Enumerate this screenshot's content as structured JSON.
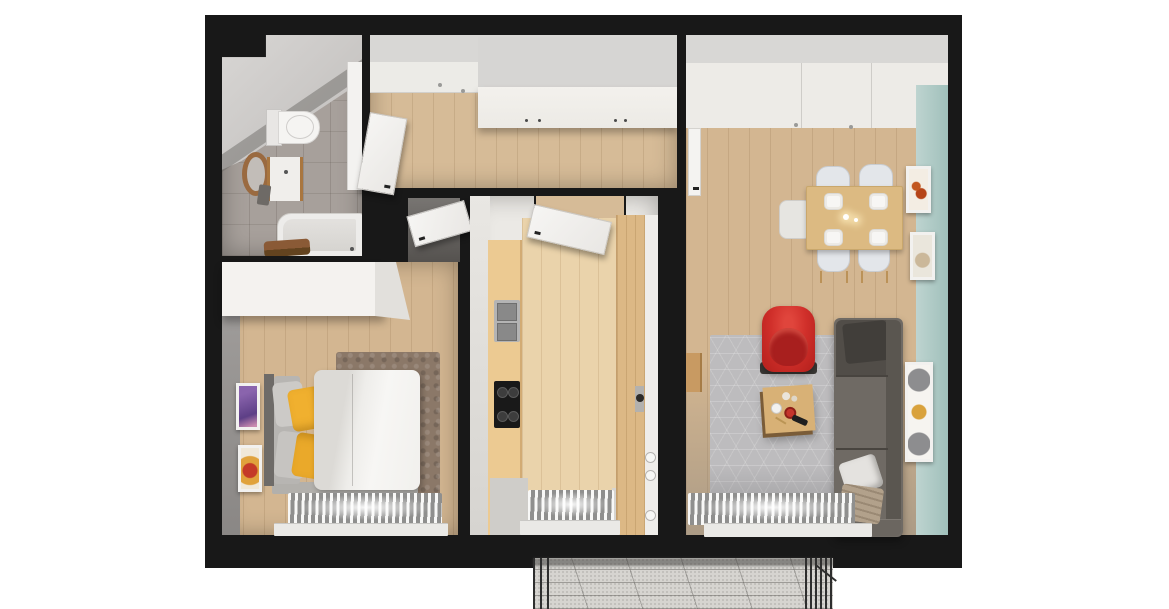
{
  "meta": {
    "title": "Two-room apartment — top-down 3D floor plan render",
    "view": "top-down axonometric",
    "visible_text": "none"
  },
  "colors": {
    "page_bg": "#ffffff",
    "wall": "#181818",
    "wood_floor": "#d3b691",
    "wood_floor_light": "#ead3ab",
    "hall_wood": "#d6bb97",
    "tile": "#a7a09b",
    "teal_wall": "#a0c0bb",
    "accent_red": "#d02f2a",
    "rug_gray": "#bdbcbe",
    "rug_brown": "#8b7868",
    "sofa_gray": "#6f6a64",
    "counter_wood": "#ecca92",
    "table_wood": "#dcba82",
    "pillow_yellow": "#f0b02f",
    "radiator_light": "#f8f8f7",
    "radiator_dark": "#8f8f8e"
  },
  "rooms": [
    {
      "id": "bathroom",
      "label": "Bathroom",
      "floor_material": "gray tile"
    },
    {
      "id": "hallway",
      "label": "Hallway",
      "floor_material": "wood"
    },
    {
      "id": "bedroom",
      "label": "Bedroom",
      "floor_material": "wood"
    },
    {
      "id": "kitchen",
      "label": "Kitchen",
      "floor_material": "wood"
    },
    {
      "id": "living_room",
      "label": "Living room",
      "floor_material": "wood"
    },
    {
      "id": "balcony",
      "label": "Balcony",
      "floor_material": "concrete with railing"
    }
  ],
  "furniture": {
    "bathroom": [
      "toilet",
      "vanity sink with round wood-framed mirror",
      "bathtub with brown towels",
      "shower panel"
    ],
    "hallway": [
      "built-in wardrobe with four handles",
      "open white door",
      "two ceiling spotlights"
    ],
    "bedroom": [
      "double bed with white duvet",
      "two yellow pillows",
      "two gray pillows",
      "gray headboard",
      "white wardrobe",
      "brown rug",
      "purple wall picture",
      "orange wall picture",
      "window radiator with sill",
      "open door"
    ],
    "kitchen": [
      "counter with stainless double sink",
      "black cooktop with four burners",
      "tall wood cabinet with round handle",
      "open white door",
      "window radiator with sill"
    ],
    "living_room": [
      "wood dining table with four plates and two candles",
      "five light chairs",
      "red armchair",
      "wood coffee table with red bowl and remote",
      "gray hexagon-pattern rug",
      "dark gray sofa with white pillow and beige blanket",
      "teal accent wall",
      "three framed pictures",
      "small wood console",
      "window radiator with sill",
      "open white door"
    ],
    "balcony": [
      "metal railing",
      "speckled concrete floor"
    ]
  }
}
